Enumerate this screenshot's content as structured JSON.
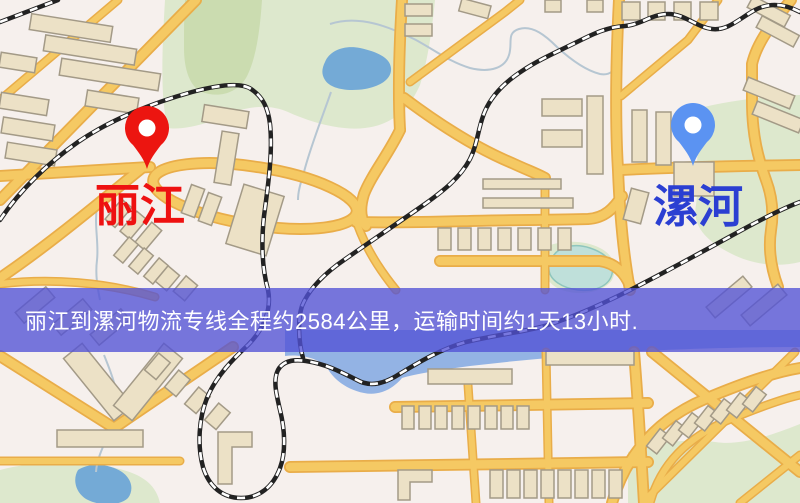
{
  "banner": {
    "text": "丽江到漯河物流专线全程约2584公里，运输时间约1天13小时.",
    "background": "rgba(82,82,214,0.78)",
    "text_color": "#ffffff"
  },
  "markers": {
    "origin": {
      "name": "丽江",
      "pin_color": "#ec1510",
      "label_color": "#ee1111"
    },
    "destination": {
      "name": "漯河",
      "pin_color": "#5b93f2",
      "label_color": "#2b3fd2"
    }
  },
  "map_palette": {
    "background": "#f6f0ed",
    "road_fill": "#f5c963",
    "road_casing": "#e9ad49",
    "building_fill": "#ece1c6",
    "building_stroke": "#a39a87",
    "green_area": "#dde8cd",
    "green_area_dark": "#cbdcb0",
    "water": "#74aad6",
    "pond_teal": "#bfe0da",
    "river": "#93b3e4",
    "railway": "#222222",
    "railway_dash": "#ffffff"
  }
}
